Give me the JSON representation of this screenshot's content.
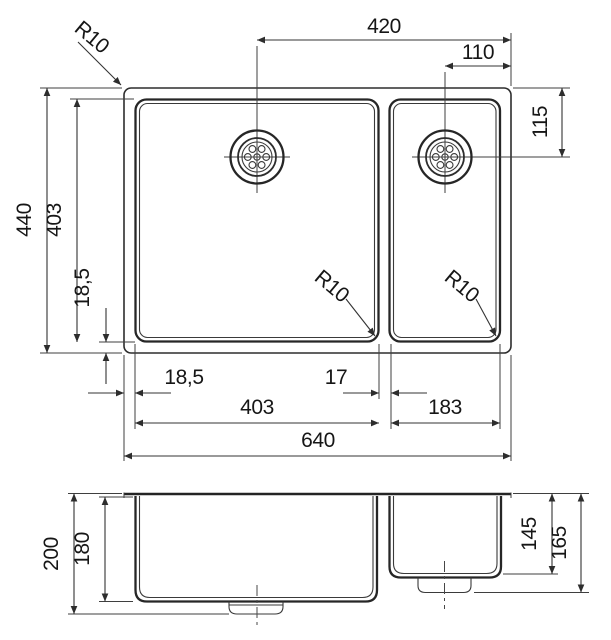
{
  "diagram": {
    "type": "technical-drawing",
    "subject": "double-bowl undermount kitchen sink, top view and front section",
    "units": "mm",
    "overall": {
      "width": 640,
      "depth": 440,
      "height": 200
    },
    "main_bowl": {
      "width": 403,
      "depth": 403,
      "inner_depth": 180,
      "corner_radius": 10,
      "rim_offset_left": 18.5,
      "rim_offset_bottom": 18.5
    },
    "half_bowl": {
      "width": 183,
      "inner_depth": 145,
      "outer_depth": 165,
      "corner_radius": 10,
      "drain_to_right_edge": 110,
      "drain_to_back_edge": 115
    },
    "divider_width": 17,
    "left_drain_to_right_edge": 420
  },
  "labels": {
    "radius": "R10",
    "top_view": {
      "drain_spacing": "420",
      "right_drain_to_edge": "110",
      "right_drain_to_back": "115",
      "overall_depth": "440",
      "bowl_depth": "403",
      "edge_offset_left": "18,5",
      "edge_offset_bottom": "18,5",
      "divider_width": "17",
      "main_bowl_width": "403",
      "half_bowl_width": "183",
      "overall_width": "640"
    },
    "front_view": {
      "overall_height": "200",
      "main_bowl_depth": "180",
      "half_bowl_inner_depth": "145",
      "half_bowl_outer_depth": "165"
    }
  }
}
